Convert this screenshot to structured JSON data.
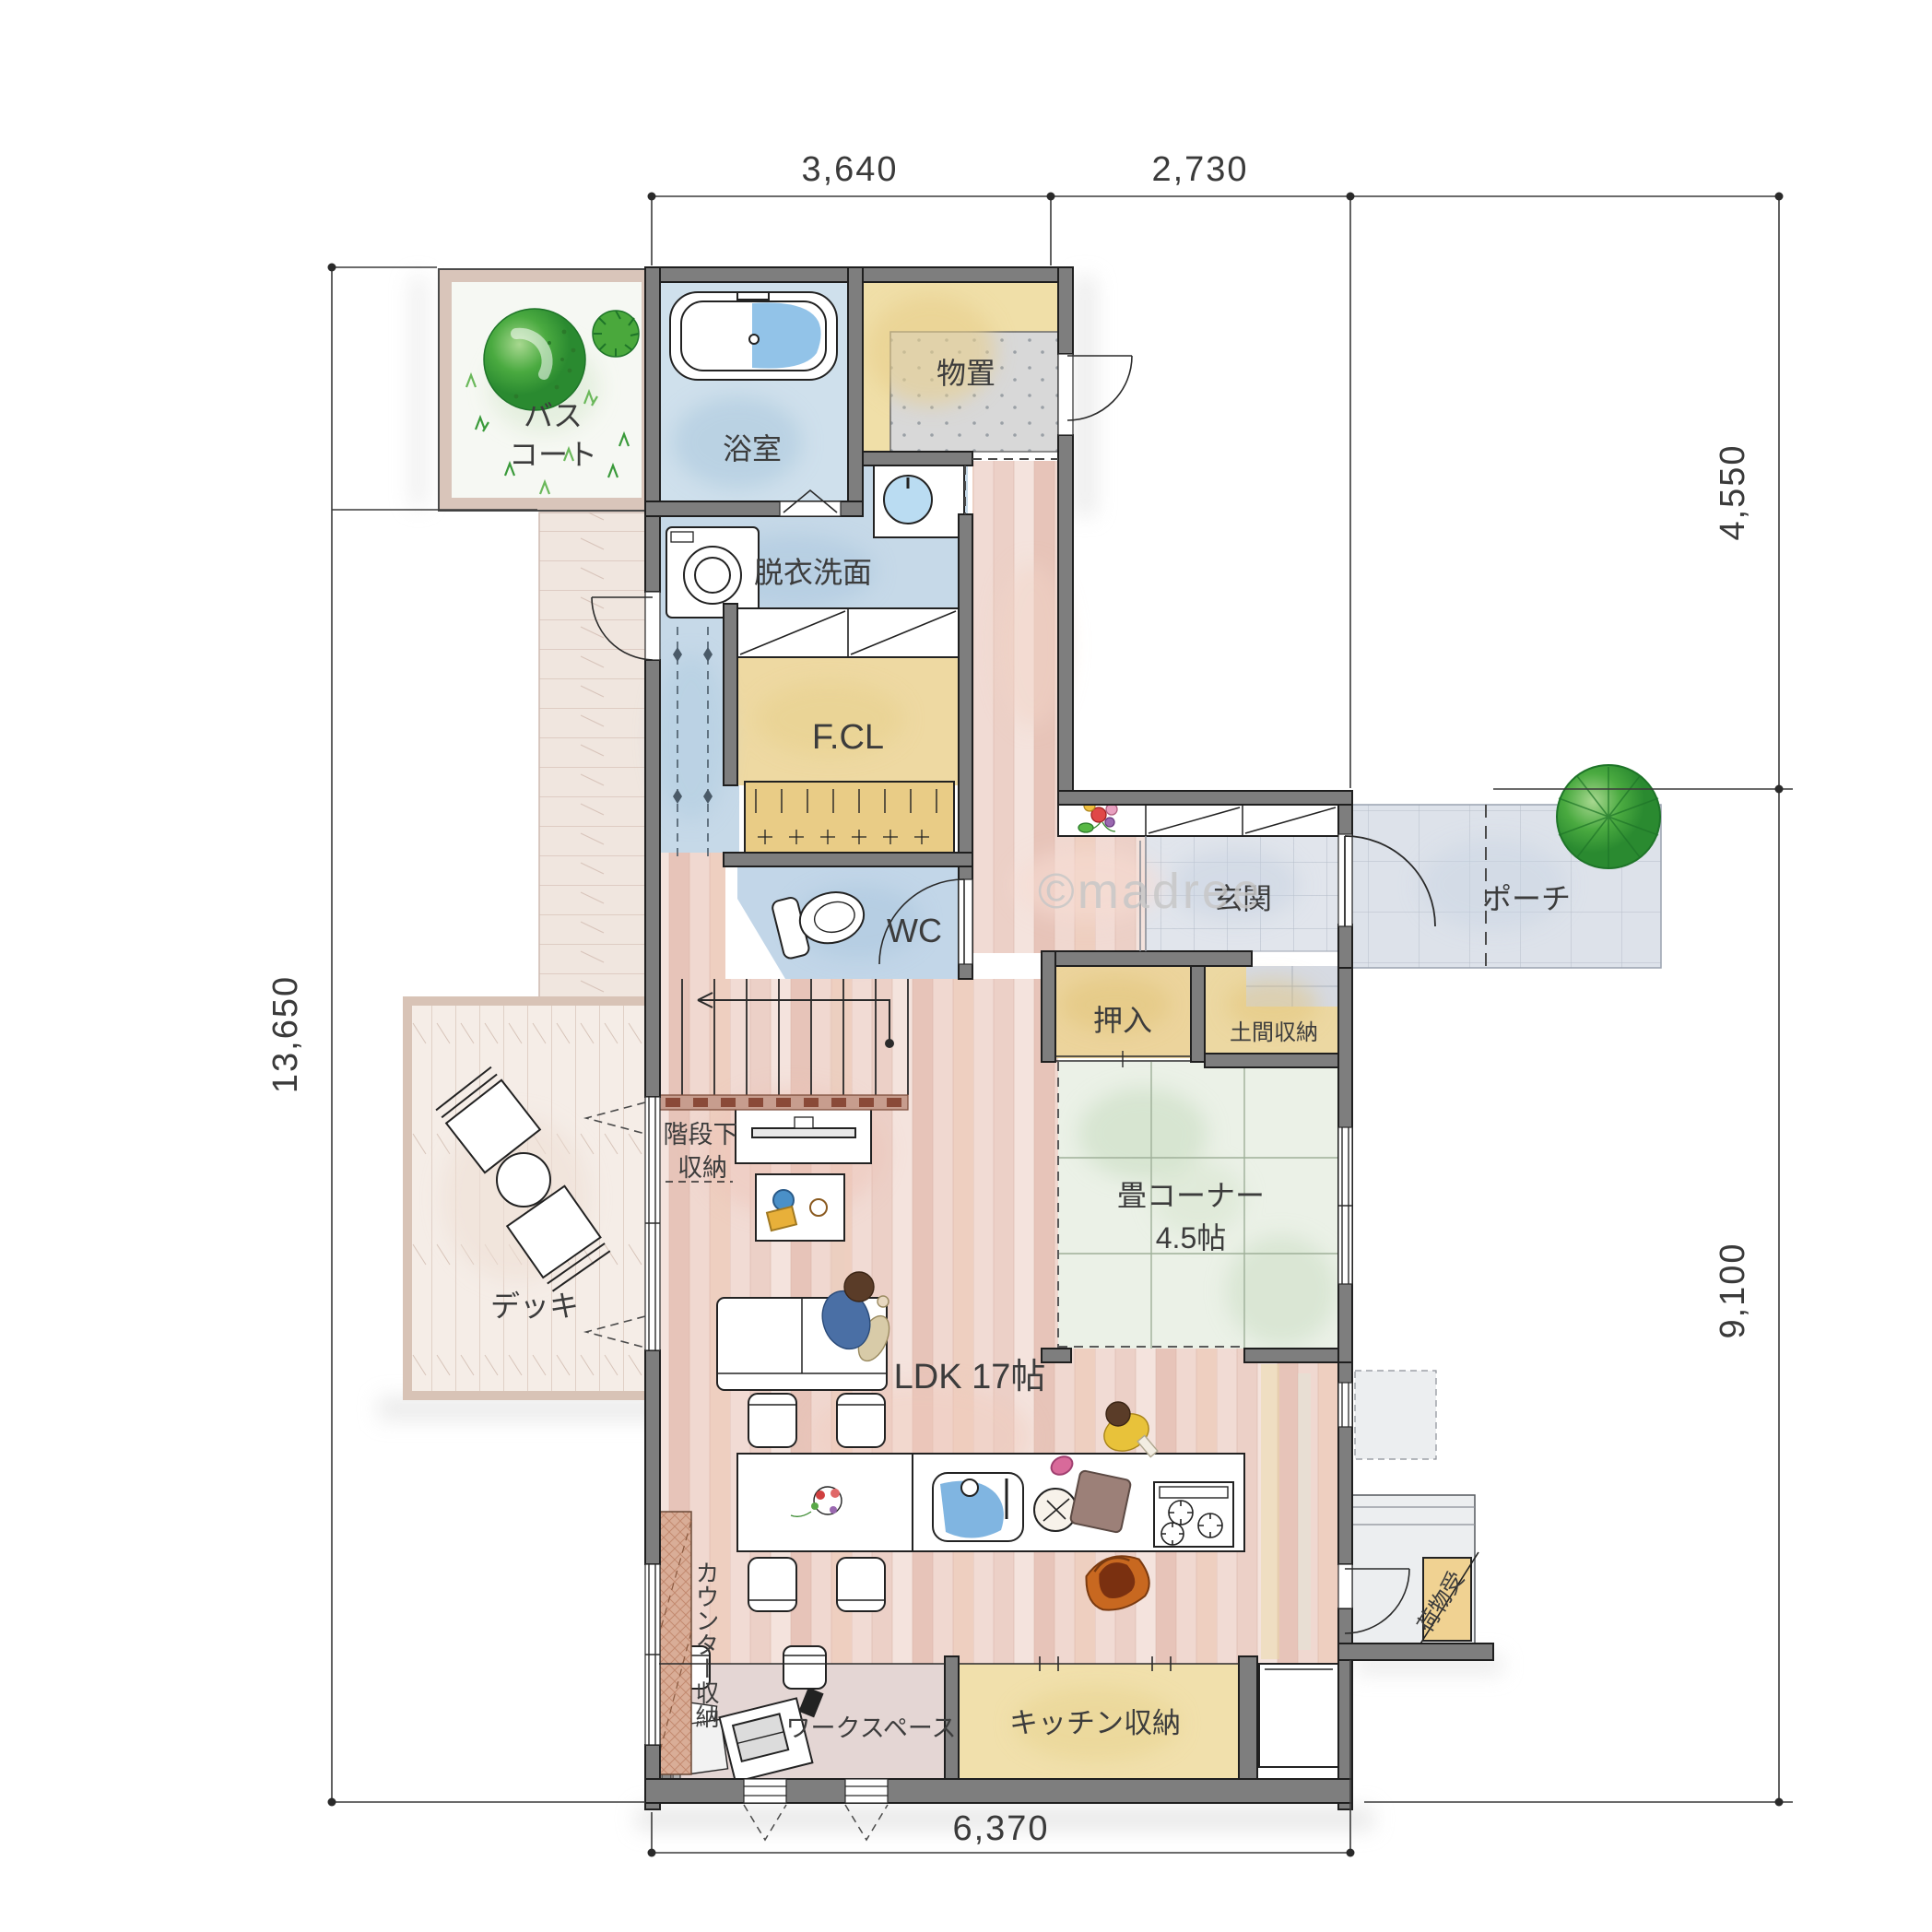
{
  "watermark": "©madree",
  "dimensions": {
    "top": [
      "3,640",
      "2,730"
    ],
    "right": [
      "4,550",
      "9,100"
    ],
    "left": "13,650",
    "bottom": "6,370"
  },
  "rooms": {
    "bath_court": {
      "lines": [
        "バス",
        "コート"
      ]
    },
    "bathroom": {
      "label": "浴室"
    },
    "storage": {
      "label": "物置"
    },
    "washroom": {
      "label": "脱衣洗面"
    },
    "family_closet": {
      "label": "F.CL"
    },
    "wc": {
      "label": "WC"
    },
    "entrance": {
      "label": "玄関"
    },
    "porch": {
      "label": "ポーチ"
    },
    "oshiire": {
      "label": "押入"
    },
    "doma_storage": {
      "label": "土間収納"
    },
    "tatami": {
      "label": "畳コーナー",
      "size": "4.5帖"
    },
    "ldk": {
      "label": "LDK 17帖"
    },
    "deck": {
      "label": "デッキ"
    },
    "under_stair": {
      "lines": [
        "階段下",
        "収納"
      ]
    },
    "counter_storage": {
      "label": "カウンター収納"
    },
    "workspace": {
      "label": "ワークスペース"
    },
    "kitchen_storage": {
      "label": "キッチン収納"
    },
    "parcel_box": {
      "label": "荷物受"
    }
  },
  "colors": {
    "wall": "#7e7e7e",
    "wood_floor": "#f2ddd7",
    "wet_area": "#c8dbe9",
    "tatami": "#ebf1e7",
    "storage_yellow": "#f0dfa8",
    "tile": "#e1e5ec",
    "deck": "#f5ede7",
    "green": "#2f9e3a"
  }
}
